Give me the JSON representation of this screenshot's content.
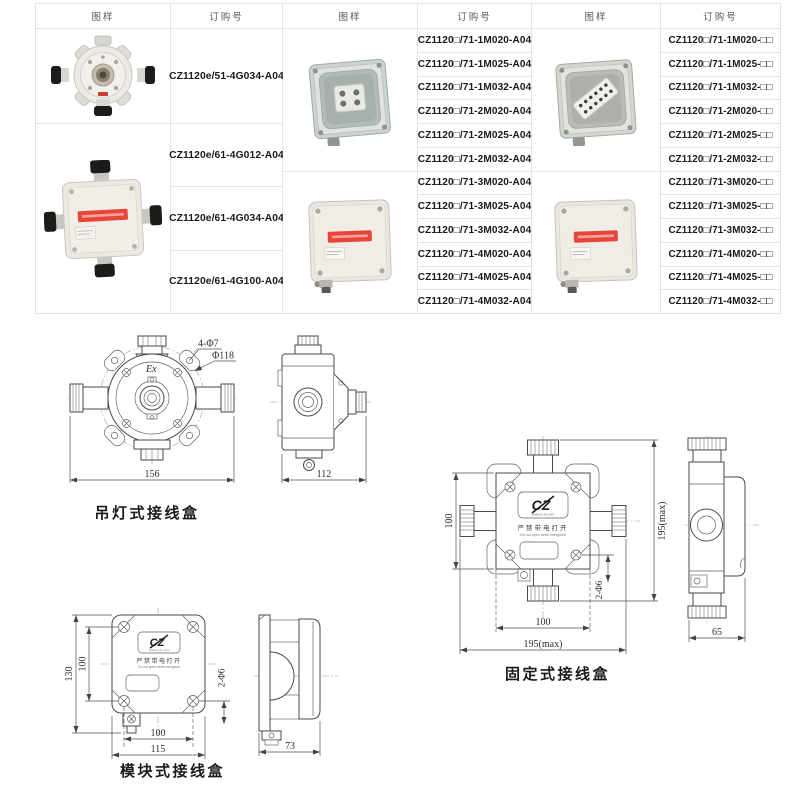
{
  "table": {
    "headers": {
      "image": "图样",
      "order": "订购号"
    },
    "groups": [
      {
        "images": [
          "round-pendant-junction-box-photo",
          "four-way-pendant-junction-box-photo"
        ],
        "rows": [
          "CZ1120e/51-4G034-A04",
          "CZ1120e/61-4G012-A04",
          "CZ1120e/61-4G034-A04",
          "CZ1120e/61-4G100-A04"
        ]
      },
      {
        "images": [
          "open-junction-box-photo",
          "closed-junction-box-red-label-photo"
        ],
        "rows": [
          "CZ1120□/71-1M020-A04",
          "CZ1120□/71-1M025-A04",
          "CZ1120□/71-1M032-A04",
          "CZ1120□/71-2M020-A04",
          "CZ1120□/71-2M025-A04",
          "CZ1120□/71-2M032-A04",
          "CZ1120□/71-3M020-A04",
          "CZ1120□/71-3M025-A04",
          "CZ1120□/71-3M032-A04",
          "CZ1120□/71-4M020-A04",
          "CZ1120□/71-4M025-A04",
          "CZ1120□/71-4M032-A04"
        ]
      },
      {
        "images": [
          "open-junction-box-terminal-strip-photo",
          "closed-junction-box-red-label-photo"
        ],
        "rows": [
          "CZ1120□/71-1M020-□□",
          "CZ1120□/71-1M025-□□",
          "CZ1120□/71-1M032-□□",
          "CZ1120□/71-2M020-□□",
          "CZ1120□/71-2M025-□□",
          "CZ1120□/71-2M032-□□",
          "CZ1120□/71-3M020-□□",
          "CZ1120□/71-3M025-□□",
          "CZ1120□/71-3M032-□□",
          "CZ1120□/71-4M020-□□",
          "CZ1120□/71-4M025-□□",
          "CZ1120□/71-4M032-□□"
        ]
      }
    ]
  },
  "drawings": {
    "pendant": {
      "caption": "吊灯式接线盒",
      "ex_mark": "Ex",
      "label_holes": "4-Φ7",
      "label_diameter": "Φ118",
      "dim_width": "156",
      "dim_depth": "112"
    },
    "fixed": {
      "caption": "固定式接线盒",
      "dim_body_height": "100",
      "dim_overall_height": "195(max)",
      "dim_body_width": "100",
      "dim_overall_width": "195(max)",
      "dim_depth": "65",
      "label_holes": "2-Φ6"
    },
    "module": {
      "caption": "模块式接线盒",
      "dim_overall_height": "130",
      "dim_hole_spacing_v": "100",
      "dim_hole_spacing_h": "100",
      "dim_body_width": "115",
      "dim_depth": "73",
      "label_holes": "2-Φ6"
    },
    "nameplate": {
      "logo": "CZ",
      "url": "www.cz-ex.com",
      "warning_cn": "严禁带电打开",
      "warning_en": "Do not open while energized"
    }
  },
  "colors": {
    "accent_red": "#e8453a",
    "table_border": "#e3e3e3",
    "line": "#4a4a4a"
  }
}
